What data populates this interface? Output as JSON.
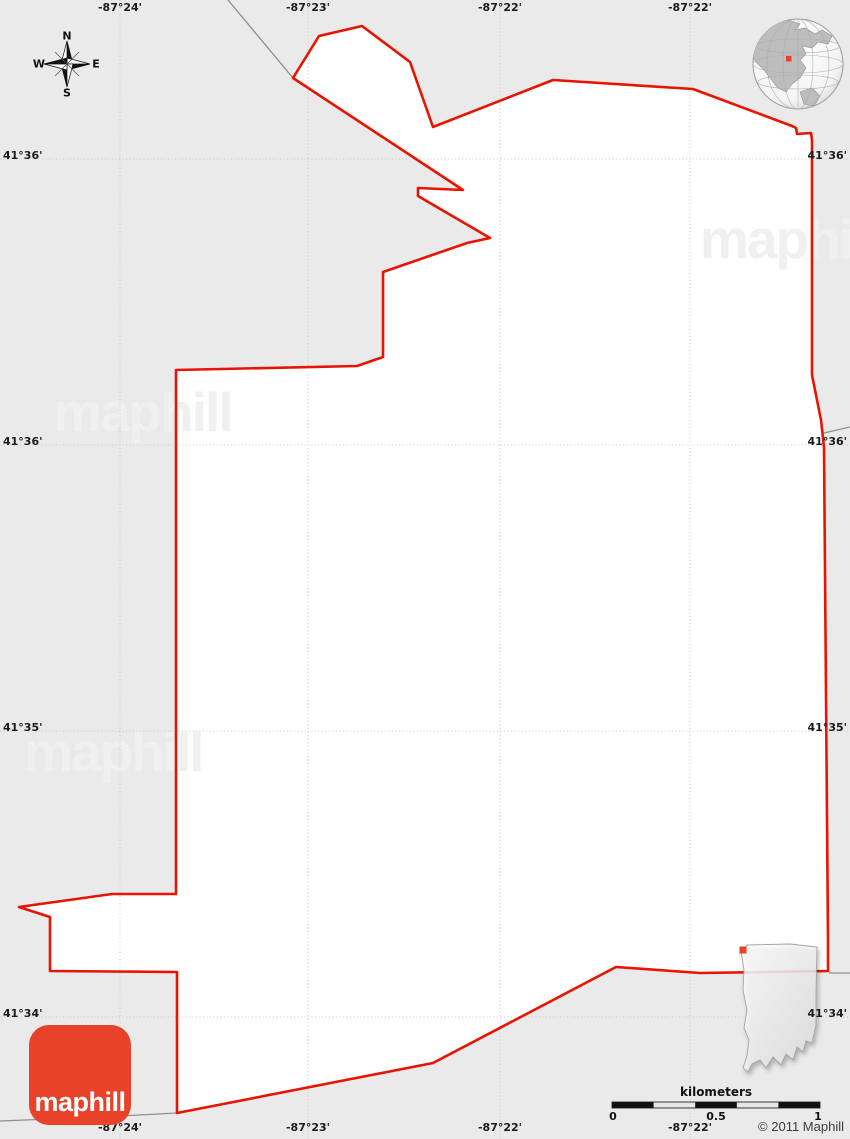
{
  "map": {
    "background": "#eaeaea",
    "region_fill": "#ffffff",
    "boundary_color": "#e81300",
    "neighbor_line_color": "#8f8f8f",
    "boundary_points": "293,78 319,36 362,26 410,62 433,127 553,80 693,89 792,126 796,128 797,134 811,133 812,140 812,375 821,420 824,447 828,940 828,971 700,973 616,967 433,1063 177,1113 177,972 50,971 50,917 19,907 112,894 176,894 176,370 357,366 383,357 383,272 467,243 490,238 418,196 418,188 463,190",
    "neighbor_lines": [
      "228,0 293,78",
      "0,1121 100,1117 177,1113",
      "824,433 850,427",
      "829,973 850,973"
    ]
  },
  "grid": {
    "line_color": "#c8c8c8",
    "meridians": [
      {
        "x": 120,
        "label": "-87°24'"
      },
      {
        "x": 308,
        "label": "-87°23'"
      },
      {
        "x": 500,
        "label": "-87°22'"
      },
      {
        "x": 690,
        "label": "-87°22'"
      }
    ],
    "parallels": [
      {
        "y": 159,
        "label": "41°36'"
      },
      {
        "y": 445,
        "label": "41°36'"
      },
      {
        "y": 731,
        "label": "41°35'"
      },
      {
        "y": 1017,
        "label": "41°34'"
      }
    ]
  },
  "compass": {
    "north": "N",
    "east": "E",
    "south": "S",
    "west": "W"
  },
  "watermark": {
    "text": "maphill",
    "color": "#f0f0f0"
  },
  "logo": {
    "text": "maphill",
    "color": "#e8432a"
  },
  "globe": {
    "marker_color": "#e8432a"
  },
  "locator": {
    "marker_color": "#e8432a"
  },
  "scalebar": {
    "title": "kilometers",
    "tick_labels": [
      "0",
      "0.5",
      "1"
    ]
  },
  "copyright": "© 2011 Maphill"
}
